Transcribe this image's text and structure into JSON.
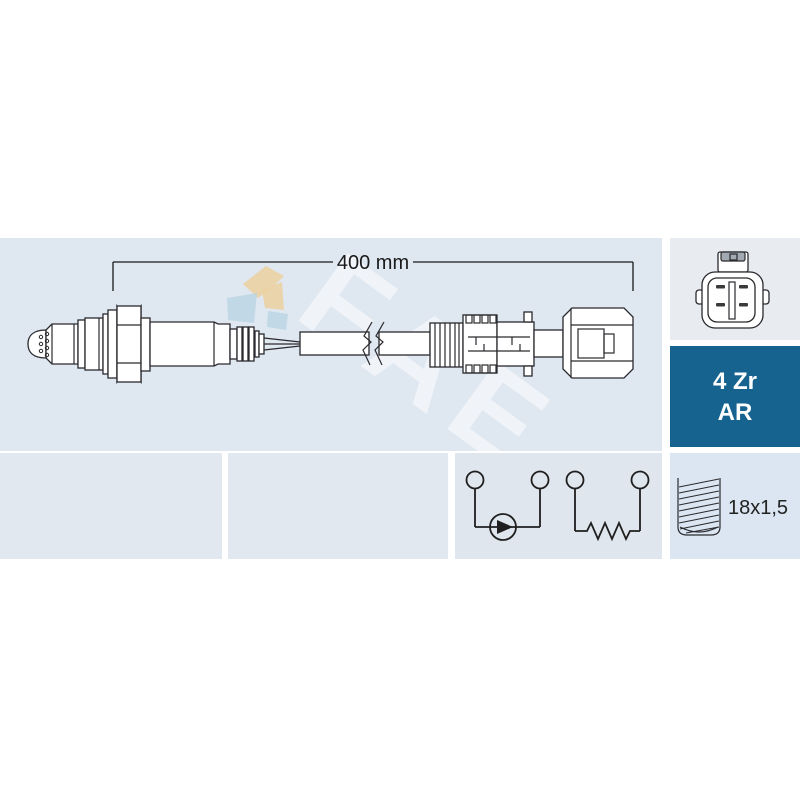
{
  "card": {
    "watermark": {
      "brand": "FAE"
    },
    "diagram": {
      "dimension_label": "400 mm"
    },
    "badge": {
      "line1": "4 Zr",
      "line2": "AR"
    },
    "thread": {
      "label": "18x1,5"
    },
    "colors": {
      "panel_light_blue": "#dfe7f0",
      "panel_connector": "#e8ebf0",
      "panel_bottom": "#e1e8f0",
      "panel_thread": "#dbe6f2",
      "badge_bg": "#166390",
      "badge_text": "#ffffff",
      "drawing_line": "#2a2a2e",
      "dimension_text": "#1a1a1a",
      "watermark_tan": "#ecd0a0",
      "watermark_blue": "#b7d4e4"
    }
  }
}
